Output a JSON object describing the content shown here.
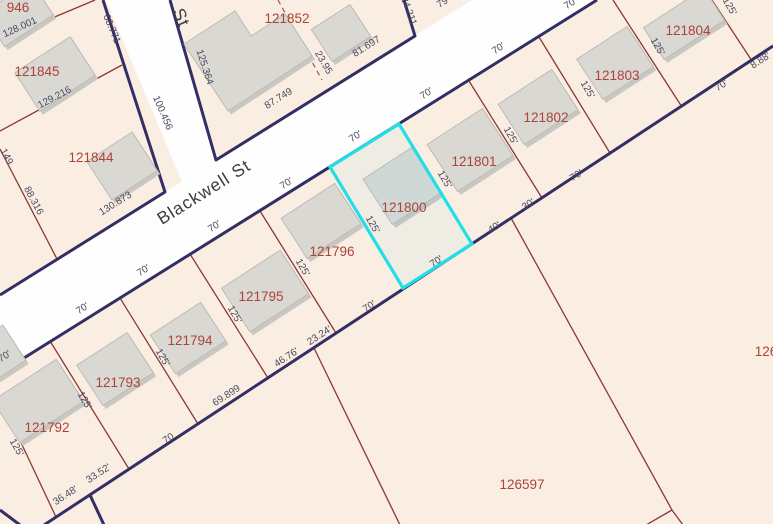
{
  "map": {
    "colors": {
      "background": "#faeee3",
      "road_fill": "#fefefe",
      "casing": "#332e63",
      "parcel_line": "#8e3734",
      "dashed_line": "#a0524e",
      "parcel_label": "#ad4238",
      "dim_label": "#4a4960",
      "street_label": "#3c3c42",
      "building_fill": "#d9d8d3",
      "building_shadow": "#c8c7c1",
      "building_stroke": "#bdbcb6",
      "highlight": "#22dfe6"
    },
    "highlighted_parcel": "121800",
    "streets": [
      {
        "name": "Blackwell St",
        "x": 207,
        "y": 197,
        "rot": -32
      },
      {
        "name": "St",
        "x": 176,
        "y": 20,
        "rot": 66
      }
    ],
    "road_polygons": [
      [
        [
          0,
          295
        ],
        [
          472,
          0
        ],
        [
          597,
          0
        ],
        [
          0,
          373
        ]
      ],
      [
        [
          106,
          0
        ],
        [
          172,
          0
        ],
        [
          216,
          160
        ],
        [
          182,
          182
        ]
      ]
    ],
    "casings": [
      [
        [
          0,
          373
        ],
        [
          597,
          0
        ]
      ],
      [
        [
          0,
          295
        ],
        [
          165,
          192
        ],
        [
          103,
          0
        ]
      ],
      [
        [
          170,
          0
        ],
        [
          216,
          160
        ],
        [
          415,
          36
        ],
        [
          404,
          0
        ]
      ],
      [
        [
          44,
          525
        ],
        [
          773,
          46
        ]
      ],
      [
        [
          90,
          495
        ],
        [
          104,
          525
        ]
      ],
      [
        [
          0,
          510
        ],
        [
          20,
          525
        ]
      ]
    ],
    "parcel_lines": [
      [
        [
          0,
          40
        ],
        [
          95,
          0
        ]
      ],
      [
        [
          0,
          131
        ],
        [
          122,
          65
        ]
      ],
      [
        [
          0,
          149
        ],
        [
          57,
          259
        ]
      ],
      [
        [
          0,
          398
        ],
        [
          56,
          517
        ]
      ],
      [
        [
          50,
          341
        ],
        [
          129,
          469
        ]
      ],
      [
        [
          120,
          298
        ],
        [
          198,
          424
        ]
      ],
      [
        [
          190,
          254
        ],
        [
          268,
          378
        ]
      ],
      [
        [
          260,
          211
        ],
        [
          336,
          333
        ]
      ],
      [
        [
          469,
          81
        ],
        [
          542,
          198
        ]
      ],
      [
        [
          539,
          37
        ],
        [
          610,
          153
        ]
      ],
      [
        [
          613,
          0
        ],
        [
          682,
          107
        ]
      ],
      [
        [
          712,
          0
        ],
        [
          752,
          61
        ]
      ],
      [
        [
          511,
          218
        ],
        [
          672,
          510
        ]
      ],
      [
        [
          672,
          510
        ],
        [
          646,
          525
        ]
      ],
      [
        [
          672,
          510
        ],
        [
          683,
          525
        ]
      ],
      [
        [
          314,
          348
        ],
        [
          400,
          525
        ]
      ]
    ],
    "dashed_lines": [
      [
        [
          278,
          0
        ],
        [
          322,
          80
        ]
      ]
    ],
    "buildings": [
      {
        "cx": 18,
        "cy": 14,
        "w": 58,
        "h": 40,
        "rot": -33
      },
      {
        "cx": 55,
        "cy": 74,
        "w": 66,
        "h": 46,
        "rot": -33
      },
      {
        "cx": 122,
        "cy": 166,
        "w": 54,
        "h": 46,
        "rot": -33
      },
      {
        "pts": [
          [
            184,
            44
          ],
          [
            235,
            11
          ],
          [
            251,
            36
          ],
          [
            285,
            14
          ],
          [
            312,
            56
          ],
          [
            228,
            111
          ]
        ]
      },
      {
        "cx": 341,
        "cy": 33,
        "w": 46,
        "h": 38,
        "rot": -33
      },
      {
        "cx": 684,
        "cy": 24,
        "w": 72,
        "h": 38,
        "rot": -33
      },
      {
        "cx": 615,
        "cy": 63,
        "w": 60,
        "h": 48,
        "rot": -33
      },
      {
        "cx": 538,
        "cy": 107,
        "w": 64,
        "h": 48,
        "rot": -33
      },
      {
        "cx": 470,
        "cy": 150,
        "w": 66,
        "h": 56,
        "rot": -33
      },
      {
        "cx": 402,
        "cy": 186,
        "w": 58,
        "h": 54,
        "rot": -33
      },
      {
        "cx": 321,
        "cy": 221,
        "w": 64,
        "h": 48,
        "rot": -33
      },
      {
        "cx": 265,
        "cy": 291,
        "w": 70,
        "h": 52,
        "rot": -33
      },
      {
        "cx": 188,
        "cy": 338,
        "w": 60,
        "h": 46,
        "rot": -33
      },
      {
        "cx": 115,
        "cy": 369,
        "w": 60,
        "h": 48,
        "rot": -33
      },
      {
        "cx": 38,
        "cy": 401,
        "w": 76,
        "h": 50,
        "rot": -33
      },
      {
        "cx": 0,
        "cy": 352,
        "w": 34,
        "h": 42,
        "rot": -33
      }
    ],
    "highlight_polygon": [
      [
        330,
        167
      ],
      [
        399,
        124
      ],
      [
        472,
        244
      ],
      [
        403,
        288
      ]
    ],
    "labels": [
      {
        "text": "946",
        "x": 18,
        "y": 12,
        "rot": 0,
        "cls": "parcel"
      },
      {
        "text": "121845",
        "x": 37,
        "y": 76,
        "rot": 0,
        "cls": "parcel"
      },
      {
        "text": "121844",
        "x": 91,
        "y": 162,
        "rot": 0,
        "cls": "parcel"
      },
      {
        "text": "121852",
        "x": 287,
        "y": 23,
        "rot": 0,
        "cls": "parcel"
      },
      {
        "text": "121804",
        "x": 688,
        "y": 35,
        "rot": 0,
        "cls": "parcel"
      },
      {
        "text": "121803",
        "x": 617,
        "y": 80,
        "rot": 0,
        "cls": "parcel"
      },
      {
        "text": "121802",
        "x": 546,
        "y": 122,
        "rot": 0,
        "cls": "parcel"
      },
      {
        "text": "121801",
        "x": 474,
        "y": 166,
        "rot": 0,
        "cls": "parcel"
      },
      {
        "text": "121800",
        "x": 404,
        "y": 212,
        "rot": 0,
        "cls": "parcel"
      },
      {
        "text": "121796",
        "x": 332,
        "y": 256,
        "rot": 0,
        "cls": "parcel"
      },
      {
        "text": "121795",
        "x": 261,
        "y": 301,
        "rot": 0,
        "cls": "parcel"
      },
      {
        "text": "121794",
        "x": 190,
        "y": 345,
        "rot": 0,
        "cls": "parcel"
      },
      {
        "text": "121793",
        "x": 118,
        "y": 387,
        "rot": 0,
        "cls": "parcel"
      },
      {
        "text": "121792",
        "x": 47,
        "y": 432,
        "rot": 0,
        "cls": "parcel"
      },
      {
        "text": "126597",
        "x": 522,
        "y": 489,
        "rot": 0,
        "cls": "parcel"
      },
      {
        "text": "126",
        "x": 766,
        "y": 356,
        "rot": 0,
        "cls": "parcel"
      },
      {
        "text": "68.771",
        "x": 109,
        "y": 30,
        "rot": 67,
        "cls": "dim"
      },
      {
        "text": "100.456",
        "x": 160,
        "y": 114,
        "rot": 67,
        "cls": "dim"
      },
      {
        "text": "125.364",
        "x": 202,
        "y": 68,
        "rot": 72,
        "cls": "dim"
      },
      {
        "text": "128.001",
        "x": 21,
        "y": 30,
        "rot": -24,
        "cls": "dim"
      },
      {
        "text": "129.216",
        "x": 56,
        "y": 100,
        "rot": -28,
        "cls": "dim"
      },
      {
        "text": "88.316",
        "x": 31,
        "y": 202,
        "rot": 62,
        "cls": "dim"
      },
      {
        "text": "149",
        "x": 4,
        "y": 158,
        "rot": 62,
        "cls": "dim"
      },
      {
        "text": "130.873",
        "x": 117,
        "y": 206,
        "rot": -32,
        "cls": "dim"
      },
      {
        "text": "87.749",
        "x": 280,
        "y": 101,
        "rot": -32,
        "cls": "dim"
      },
      {
        "text": "23.95",
        "x": 321,
        "y": 64,
        "rot": 60,
        "cls": "dim"
      },
      {
        "text": "81.697",
        "x": 368,
        "y": 49,
        "rot": -32,
        "cls": "dim"
      },
      {
        "text": "24.211",
        "x": 406,
        "y": 12,
        "rot": 70,
        "cls": "dim"
      },
      {
        "text": "79",
        "x": 444,
        "y": 5,
        "rot": -32,
        "cls": "dim"
      },
      {
        "text": "70'",
        "x": 6,
        "y": 359,
        "rot": -32,
        "cls": "dim"
      },
      {
        "text": "70'",
        "x": 84,
        "y": 311,
        "rot": -32,
        "cls": "dim"
      },
      {
        "text": "70'",
        "x": 145,
        "y": 273,
        "rot": -32,
        "cls": "dim"
      },
      {
        "text": "70'",
        "x": 216,
        "y": 229,
        "rot": -32,
        "cls": "dim"
      },
      {
        "text": "70'",
        "x": 288,
        "y": 186,
        "rot": -32,
        "cls": "dim"
      },
      {
        "text": "70'",
        "x": 357,
        "y": 139,
        "rot": -32,
        "cls": "dim"
      },
      {
        "text": "70'",
        "x": 428,
        "y": 96,
        "rot": -32,
        "cls": "dim"
      },
      {
        "text": "70'",
        "x": 500,
        "y": 51,
        "rot": -32,
        "cls": "dim"
      },
      {
        "text": "70'",
        "x": 572,
        "y": 6,
        "rot": -32,
        "cls": "dim"
      },
      {
        "text": "36.48'",
        "x": 67,
        "y": 498,
        "rot": -33,
        "cls": "dim"
      },
      {
        "text": "33.52'",
        "x": 100,
        "y": 476,
        "rot": -33,
        "cls": "dim"
      },
      {
        "text": "70",
        "x": 170,
        "y": 441,
        "rot": -33,
        "cls": "dim"
      },
      {
        "text": "69.899",
        "x": 228,
        "y": 398,
        "rot": -33,
        "cls": "dim"
      },
      {
        "text": "46.76'",
        "x": 288,
        "y": 360,
        "rot": -33,
        "cls": "dim"
      },
      {
        "text": "23.24'",
        "x": 321,
        "y": 338,
        "rot": -33,
        "cls": "dim"
      },
      {
        "text": "70'",
        "x": 371,
        "y": 309,
        "rot": -33,
        "cls": "dim"
      },
      {
        "text": "70'",
        "x": 438,
        "y": 264,
        "rot": -33,
        "cls": "dim"
      },
      {
        "text": "40'",
        "x": 496,
        "y": 230,
        "rot": -33,
        "cls": "dim"
      },
      {
        "text": "30'",
        "x": 530,
        "y": 207,
        "rot": -33,
        "cls": "dim"
      },
      {
        "text": "70'",
        "x": 578,
        "y": 178,
        "rot": -33,
        "cls": "dim"
      },
      {
        "text": "70'",
        "x": 723,
        "y": 88,
        "rot": -33,
        "cls": "dim"
      },
      {
        "text": "8.88'",
        "x": 762,
        "y": 63,
        "rot": -33,
        "cls": "dim"
      },
      {
        "text": "125'",
        "x": 14,
        "y": 449,
        "rot": 60,
        "cls": "dim"
      },
      {
        "text": "125'",
        "x": 82,
        "y": 402,
        "rot": 60,
        "cls": "dim"
      },
      {
        "text": "125'",
        "x": 160,
        "y": 359,
        "rot": 60,
        "cls": "dim"
      },
      {
        "text": "125'",
        "x": 232,
        "y": 316,
        "rot": 60,
        "cls": "dim"
      },
      {
        "text": "125'",
        "x": 300,
        "y": 269,
        "rot": 60,
        "cls": "dim"
      },
      {
        "text": "125'",
        "x": 370,
        "y": 226,
        "rot": 60,
        "cls": "dim"
      },
      {
        "text": "125'",
        "x": 442,
        "y": 181,
        "rot": 60,
        "cls": "dim"
      },
      {
        "text": "125'",
        "x": 508,
        "y": 137,
        "rot": 60,
        "cls": "dim"
      },
      {
        "text": "125'",
        "x": 585,
        "y": 91,
        "rot": 60,
        "cls": "dim"
      },
      {
        "text": "125'",
        "x": 655,
        "y": 48,
        "rot": 60,
        "cls": "dim"
      },
      {
        "text": "125'",
        "x": 727,
        "y": 8,
        "rot": 60,
        "cls": "dim"
      }
    ]
  }
}
